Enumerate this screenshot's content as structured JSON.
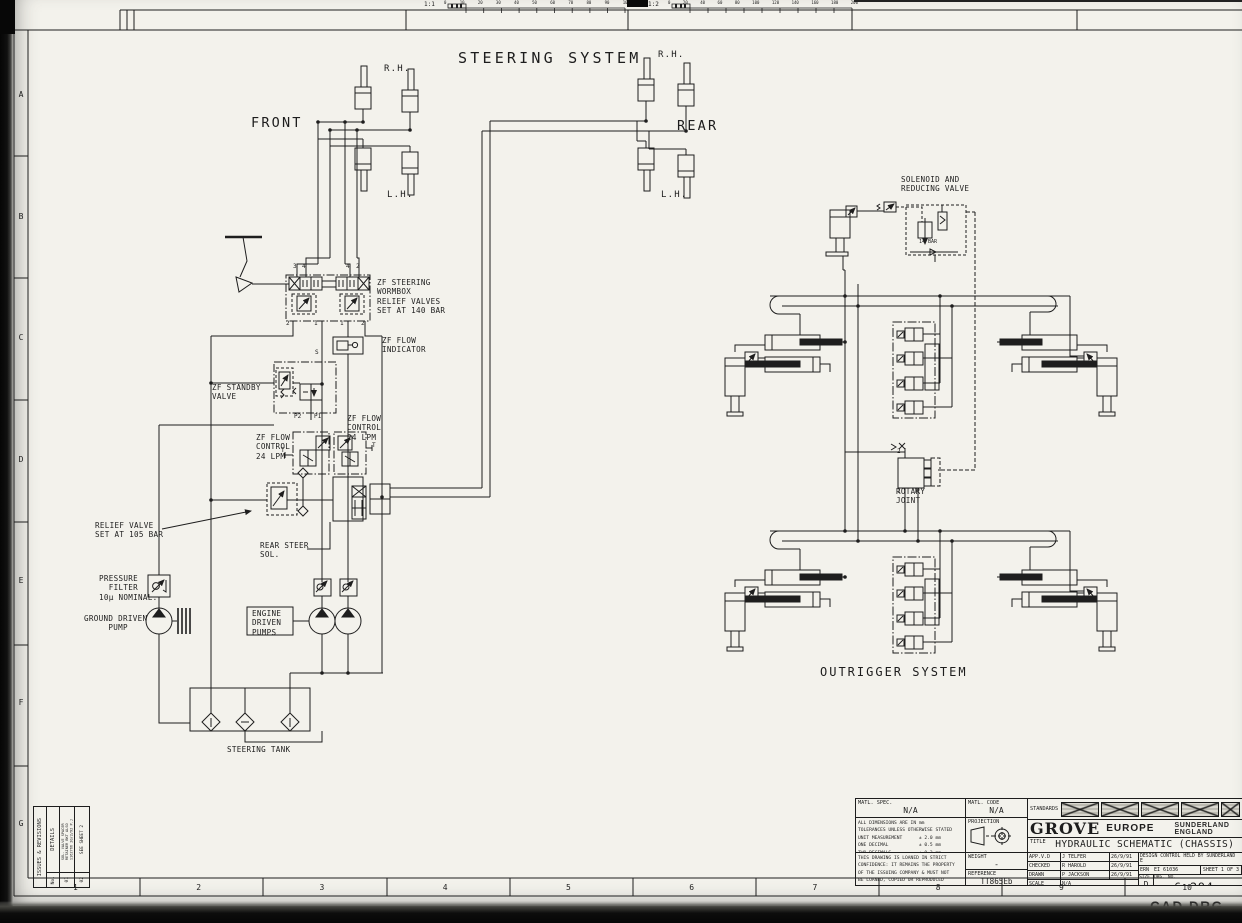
{
  "sheet": {
    "ruler1_label": "1:1",
    "ruler1_ticks": [
      "0",
      "10",
      "20",
      "30",
      "40",
      "50",
      "60",
      "70",
      "80",
      "90",
      "100"
    ],
    "ruler2_label": "1:2",
    "ruler2_ticks": [
      "0",
      "20",
      "40",
      "60",
      "80",
      "100",
      "120",
      "140",
      "160",
      "180",
      "200"
    ],
    "zone_letters": [
      "A",
      "B",
      "C",
      "D",
      "E",
      "F",
      "G"
    ],
    "zone_numbers": [
      "1",
      "2",
      "3",
      "4",
      "5",
      "6",
      "7",
      "8",
      "9",
      "10"
    ],
    "cad_note": "CAD DRG"
  },
  "steering": {
    "title": "STEERING SYSTEM",
    "front": "FRONT",
    "rear": "REAR",
    "rh_front": "R.H.",
    "lh_front": "L.H.",
    "rh_rear": "R.H.",
    "lh_rear": "L.H.",
    "wormbox_label": "ZF STEERING\nWORMBOX\nRELIEF VALVES\nSET AT 140 BAR",
    "flow_indicator_label": "ZF FLOW\nINDICATOR",
    "standby_label": "ZF STANDBY\nVALVE",
    "flow_control_left": "ZF FLOW\nCONTROL\n24 LPM",
    "flow_control_right": "ZF FLOW\nCONTROL\n24 LPM",
    "relief_label": "RELIEF VALVE\nSET AT 105 BAR",
    "rear_steer_label": "REAR STEER\nSOL.",
    "filter_label": "PRESSURE\n  FILTER\n10µ NOMINAL.",
    "ground_pump_label": "GROUND DRIVEN\n     PUMP",
    "engine_pumps_label": "ENGINE\nDRIVEN\nPUMPS",
    "tank_label": "STEERING TANK",
    "wormbox_ports_top": [
      "3",
      "4",
      "4",
      "2"
    ],
    "wormbox_ports_bottom": [
      "2",
      "1",
      "1",
      "2"
    ],
    "port_s": "S",
    "port_p2": "P2",
    "port_p1": "P1",
    "port_t_left": "T",
    "port_t_right": "T"
  },
  "outrigger": {
    "title": "OUTRIGGER SYSTEM",
    "solenoid_label": "SOLENOID AND\nREDUCING VALVE",
    "pressure_label": "14 BAR",
    "rotary_label": "ROTARY\nJOINT",
    "rotary_port_top": "2",
    "rotary_port_bottom": "1",
    "rotary_port_m": "M"
  },
  "title_block": {
    "matl_spec_label": "MATL. SPEC.",
    "matl_spec_value": "N/A",
    "matl_code_label": "MATL. CODE",
    "matl_code_value": "N/A",
    "standards_label": "STANDARDS",
    "projection_label": "PROJECTION",
    "company": "GROVE",
    "company_suffix": "EUROPE",
    "company_location": "SUNDERLAND ENGLAND",
    "title_label": "TITLE",
    "title_value": "HYDRAULIC SCHEMATIC (CHASSIS)",
    "tolerances": "ALL DIMENSIONS ARE IN mm\nTOLERANCES UNLESS OTHERWISE STATED\nUNIT MEASUREMENT      ± 2.0 mm\nONE DECIMAL           ± 0.5 mm\nTWO DECIMALS          ± 0.3 mm\nMACHINED              ± 0.25 mm\nREMOVE BURRS & SHARP EDGES",
    "confidence_note": "THIS DRAWING IS LOANED IN STRICT\nCONFIDENCE: IT REMAINS THE PROPERTY\nOF THE ISSUING COMPANY & MUST NOT\nBE LOANED, COPIED OR REPRODUCED\nWITHOUT THEIR PERMISSION",
    "weight_label": "WEIGHT",
    "weight_value": "-",
    "reference_label": "REFERENCE",
    "reference_value": "TT865Eb",
    "scale_label": "SCALE",
    "scale_value": "N/A",
    "approvals": [
      {
        "role": "APP.V.D",
        "name": "J TELFER",
        "date": "26/9/91"
      },
      {
        "role": "CHECKED",
        "name": "R HAROLD",
        "date": "26/9/91"
      },
      {
        "role": "DRAWN",
        "name": "P JACKSON",
        "date": "26/9/91"
      }
    ],
    "design_control": "DESIGN CONTROL HELD BY SUNDERLAND E",
    "ern_label": "ERN",
    "ern_value": "EI 61036",
    "sheet_value": "SHEET 1 OF 3",
    "size_label": "SIZE",
    "size_value": "D",
    "drg_no_label": "DRG. NO.",
    "drg_no_value": "6-294-991934"
  },
  "revisions": {
    "header": "ISSUES & REVISIONS",
    "details_label": "DETAILS",
    "no_label": "No.",
    "rows": [
      {
        "no": "01",
        "text": "SOL. VALVE SPACER\nRETAINER BKT ALSO\n1162766 20/2/92 P.J"
      },
      {
        "no": "02",
        "text": "SEE SHEET 2"
      }
    ]
  }
}
